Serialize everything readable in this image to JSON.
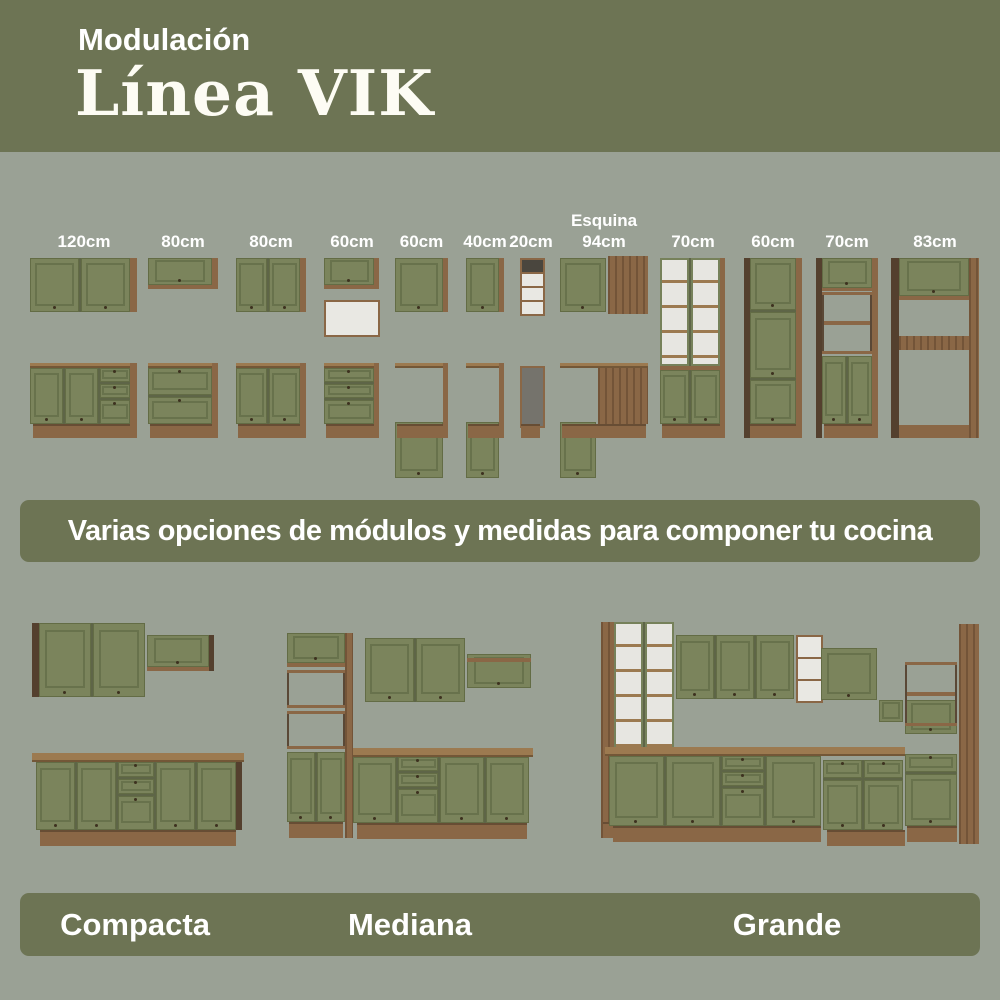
{
  "header": {
    "subtitle": "Modulación",
    "title": "Línea VIK"
  },
  "modules": [
    {
      "label": "120cm"
    },
    {
      "label": "80cm"
    },
    {
      "label": "80cm"
    },
    {
      "label": "60cm"
    },
    {
      "label": "60cm"
    },
    {
      "label": "40cm"
    },
    {
      "label": "20cm"
    },
    {
      "label1": "Esquina",
      "label": "94cm"
    },
    {
      "label": "70cm"
    },
    {
      "label": "60cm"
    },
    {
      "label": "70cm"
    },
    {
      "label": "83cm"
    }
  ],
  "banner": {
    "text": "Varias opciones de módulos y medidas para componer tu cocina"
  },
  "kitchens": [
    {
      "name": "Compacta"
    },
    {
      "name": "Mediana"
    },
    {
      "name": "Grande"
    }
  ],
  "colors": {
    "background": "#9aa195",
    "band_olive": "#6d7454",
    "door_green": "#7b845c",
    "wood": "#8a6746",
    "wood_dark": "#54402e",
    "countertop": "#9c7a50",
    "interior_white": "#e9e8e3",
    "text": "#ffffff"
  }
}
